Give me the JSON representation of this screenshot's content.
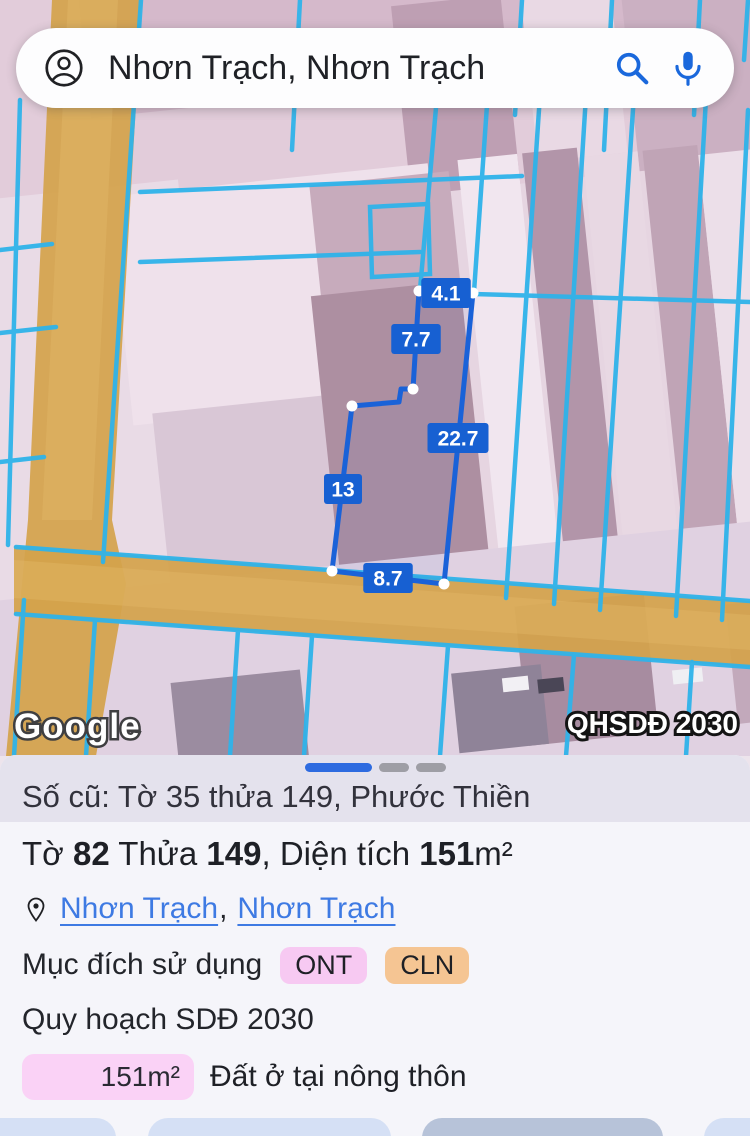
{
  "search": {
    "query": "Nhơn Trạch, Nhơn Trạch"
  },
  "map": {
    "watermark": "Google",
    "badge": "QHSDĐ 2030",
    "line_color": "#2FB3EA",
    "parcel": {
      "stroke": "#1A62D8",
      "points": [
        [
          419,
          291
        ],
        [
          473,
          293
        ],
        [
          444,
          584
        ],
        [
          332,
          571
        ],
        [
          352,
          406
        ],
        [
          399,
          402
        ],
        [
          401,
          389
        ],
        [
          413,
          389
        ]
      ],
      "vertex_dots": [
        [
          419,
          291
        ],
        [
          473,
          293
        ],
        [
          444,
          584
        ],
        [
          332,
          571
        ],
        [
          352,
          406
        ],
        [
          413,
          389
        ]
      ]
    },
    "label_bg": "#1760D2",
    "measurements": [
      {
        "label": "4.1",
        "x": 446,
        "y": 293
      },
      {
        "label": "7.7",
        "x": 416,
        "y": 339
      },
      {
        "label": "22.7",
        "x": 458,
        "y": 438
      },
      {
        "label": "13",
        "x": 343,
        "y": 489
      },
      {
        "label": "8.7",
        "x": 388,
        "y": 578
      }
    ]
  },
  "pagination": {
    "count": 3,
    "active_index": 0,
    "active_color": "#2E6BE0",
    "inactive_color": "#9E9EA5"
  },
  "panel": {
    "old_ref": "Số cũ: Tờ 35 thửa 149, Phước Thiền",
    "title": {
      "p1": "Tờ",
      "sheet": "82",
      "p2": "Thửa",
      "plot": "149",
      "p3": ", Diện tích",
      "area": "151",
      "unit": "m²"
    },
    "location": {
      "link1": "Nhơn Trạch",
      "separator": ",",
      "link2": "Nhơn Trạch"
    },
    "purpose": {
      "label": "Mục đích sử dụng",
      "badges": [
        {
          "code": "ONT",
          "bg": "#F7C9F2"
        },
        {
          "code": "CLN",
          "bg": "#F5C593"
        }
      ]
    },
    "planning": "Quy hoạch SDĐ 2030",
    "legend": {
      "area_badge": "151m²",
      "badge_bg": "#FAD2F6",
      "text": "Đất ở tại nông thôn"
    }
  }
}
